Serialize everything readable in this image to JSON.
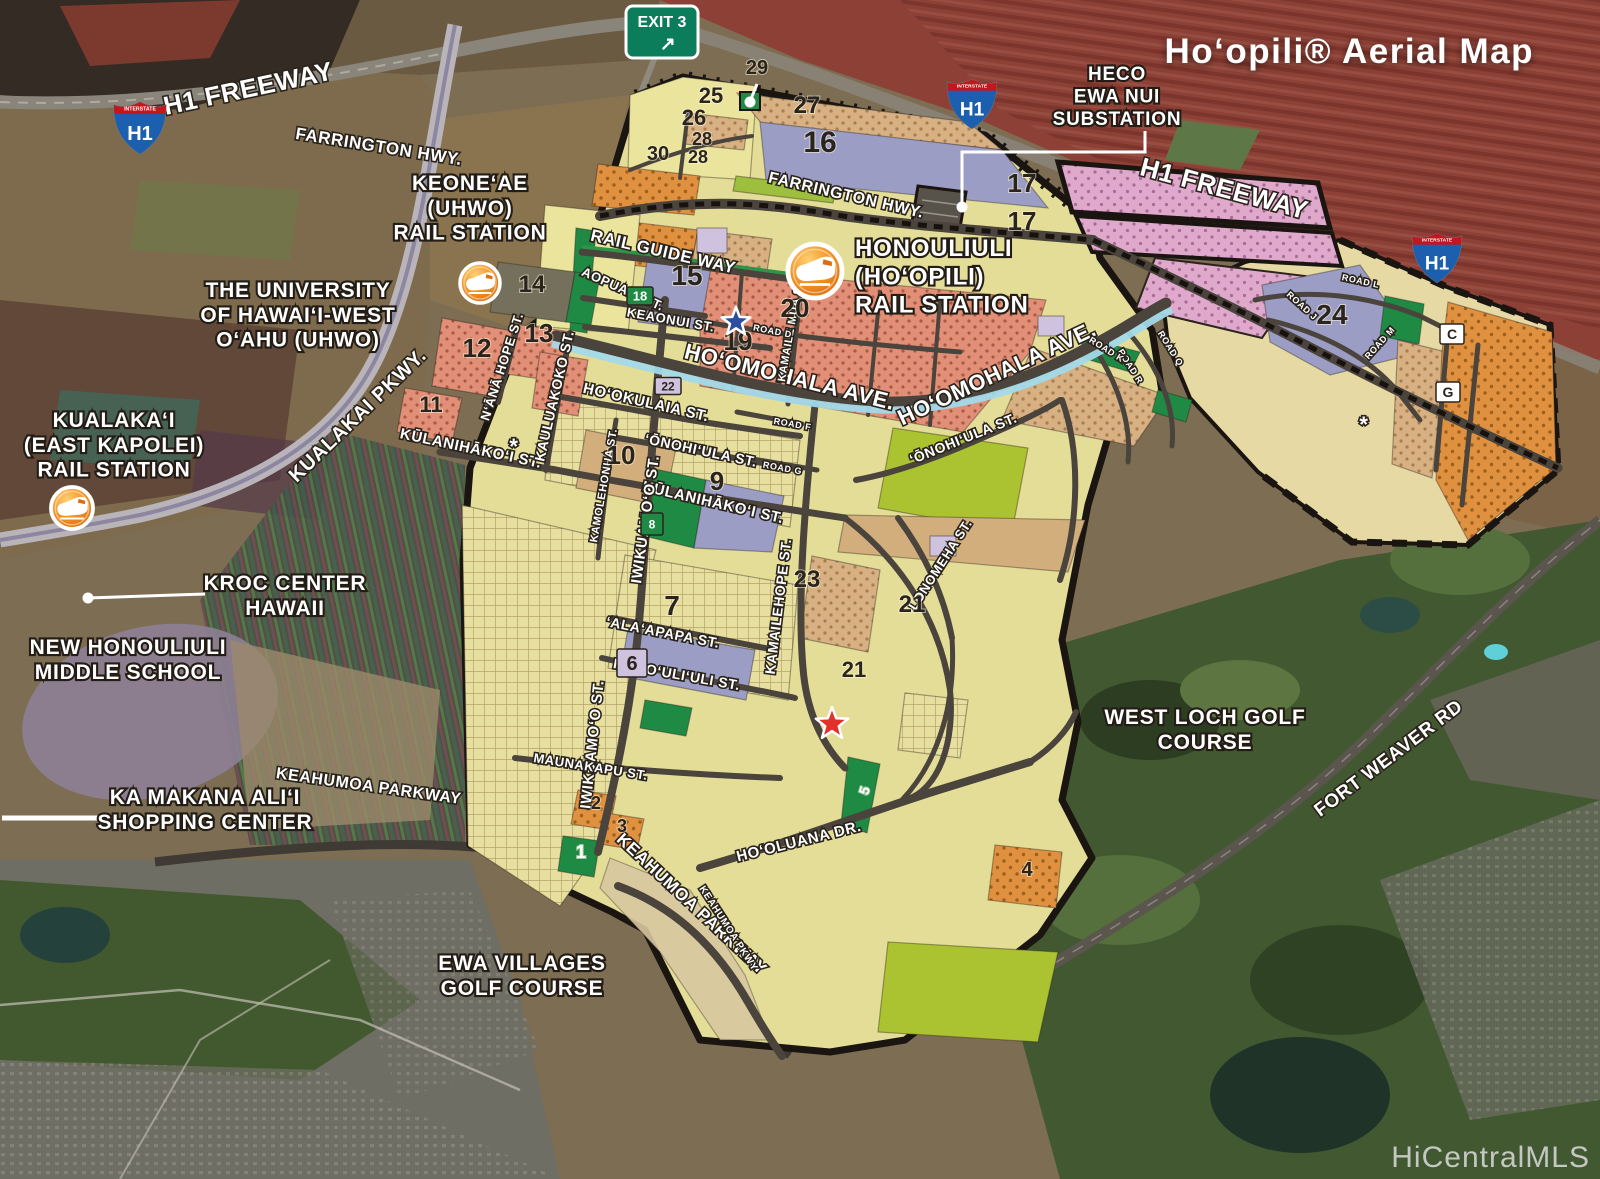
{
  "title": "Hoʻopili® Aerial Map",
  "watermark": "HiCentralMLS",
  "colors": {
    "parcel_salmon": "#e28f78",
    "parcel_tan": "#d7b183",
    "parcel_pink": "#dfa9cb",
    "parcel_khaki": "#e7df9f",
    "parcel_purple": "#9b9dc4",
    "parcel_lavender": "#cfc2df",
    "parcel_orange": "#e09140",
    "parcel_green": "#1e8a44",
    "parcel_lime": "#abc331",
    "road": "#4a443c",
    "water": "#a2d9e9",
    "boundary": "#1a1510",
    "station_orange": "#f08c1e",
    "exit_sign_green": "#0c7d5a",
    "shield_blue": "#1b5fae",
    "shield_red": "#c4161c"
  },
  "map": {
    "exit_sign": {
      "text": "EXIT 3",
      "arrow": "↗",
      "x": 626,
      "y": 6,
      "w": 72,
      "h": 52
    },
    "shields": [
      {
        "x": 140,
        "y": 127,
        "s": 1.0,
        "top": "INTERSTATE",
        "num": "H1"
      },
      {
        "x": 972,
        "y": 103,
        "s": 0.95,
        "top": "INTERSTATE",
        "num": "H1"
      },
      {
        "x": 1437,
        "y": 257,
        "s": 0.95,
        "top": "INTERSTATE",
        "num": "H1"
      }
    ],
    "stations": [
      {
        "id": "keoneae-station",
        "x": 480,
        "y": 283,
        "r": 20
      },
      {
        "id": "honouliuli-station",
        "x": 815,
        "y": 271,
        "r": 27
      },
      {
        "id": "kualakai-station",
        "x": 72,
        "y": 508,
        "r": 21
      }
    ],
    "stars": [
      {
        "color": "#2c4da0",
        "x": 736,
        "y": 322,
        "r": 15
      },
      {
        "color": "#e2302a",
        "x": 832,
        "y": 724,
        "r": 17
      }
    ],
    "asterisks": [
      {
        "x": 514,
        "y": 454
      },
      {
        "x": 1364,
        "y": 432
      }
    ],
    "leaders": [
      {
        "name": "heco-leader",
        "points": "1145,131 1145,152 962,152 962,204",
        "dot": [
          962,
          207
        ],
        "w": 3
      },
      {
        "name": "parcel29-leader",
        "points": "757,84 751,99",
        "dot": [
          750,
          102
        ],
        "w": 3
      },
      {
        "name": "kroc-leader",
        "points": "205,594 88,598",
        "dot": [
          88,
          598
        ],
        "w": 3
      },
      {
        "name": "kamakana-line",
        "points": "2,818 100,818",
        "w": 5
      }
    ],
    "place_labels": [
      {
        "id": "keoneae",
        "lines": [
          "KEONEʻAE",
          "(UHWO)",
          "RAIL STATION"
        ],
        "x": 470,
        "y": 190,
        "s": 21
      },
      {
        "id": "university",
        "lines": [
          "THE UNIVERSITY",
          "OF HAWAIʻI-WEST",
          "OʻAHU (UHWO)"
        ],
        "x": 298,
        "y": 297,
        "s": 21
      },
      {
        "id": "kualakai",
        "lines": [
          "KUALAKAʻI",
          "(EAST KAPOLEI)",
          "RAIL STATION"
        ],
        "x": 114,
        "y": 427,
        "s": 21
      },
      {
        "id": "heco",
        "lines": [
          "HECO",
          "EWA NUI",
          "SUBSTATION"
        ],
        "x": 1117,
        "y": 80,
        "s": 19
      },
      {
        "id": "honouliuli",
        "lines": [
          "HONOULIULI",
          "(HOʻOPILI)",
          "RAIL STATION"
        ],
        "x": 855,
        "y": 256,
        "s": 24,
        "align": "left"
      },
      {
        "id": "kroc",
        "lines": [
          "KROC CENTER",
          "HAWAII"
        ],
        "x": 285,
        "y": 590,
        "s": 21
      },
      {
        "id": "middle-school",
        "lines": [
          "NEW HONOULIULI",
          "MIDDLE SCHOOL"
        ],
        "x": 128,
        "y": 654,
        "s": 21
      },
      {
        "id": "ka-makana",
        "lines": [
          "KA MAKANA ALIʻI",
          "SHOPPING CENTER"
        ],
        "x": 205,
        "y": 804,
        "s": 21
      },
      {
        "id": "ewa-villages",
        "lines": [
          "EWA VILLAGES",
          "GOLF COURSE"
        ],
        "x": 522,
        "y": 970,
        "s": 21
      },
      {
        "id": "west-loch",
        "lines": [
          "WEST LOCH GOLF",
          "COURSE"
        ],
        "x": 1205,
        "y": 724,
        "s": 21
      }
    ],
    "street_labels": [
      {
        "t": "H1 FREEWAY",
        "x": 250,
        "y": 97,
        "r": -12,
        "s": 26
      },
      {
        "t": "FARRINGTON HWY.",
        "x": 378,
        "y": 152,
        "r": 9,
        "s": 17
      },
      {
        "t": "FARRINGTON HWY.",
        "x": 845,
        "y": 200,
        "r": 13,
        "s": 16
      },
      {
        "t": "H1 FREEWAY",
        "x": 1222,
        "y": 197,
        "r": 15,
        "s": 26
      },
      {
        "t": "RAIL GUIDE WAY",
        "x": 662,
        "y": 257,
        "r": 13,
        "s": 17
      },
      {
        "t": "AOPUAʻA ST.",
        "x": 621,
        "y": 293,
        "r": 24,
        "s": 13
      },
      {
        "t": "KEAONUI ST.",
        "x": 670,
        "y": 324,
        "r": 10,
        "s": 13
      },
      {
        "t": "HOʻOMOHALA AVE.",
        "x": 788,
        "y": 384,
        "r": 14,
        "s": 22
      },
      {
        "t": "HOʻOMOHALA AVE.",
        "x": 1000,
        "y": 380,
        "r": -25,
        "s": 22
      },
      {
        "t": "HOʻOKULAIA ST.",
        "x": 645,
        "y": 407,
        "r": 13,
        "s": 15
      },
      {
        "t": "ʻŌNOHIʻULA ST.",
        "x": 700,
        "y": 455,
        "r": 12,
        "s": 14
      },
      {
        "t": "ʻŌNOHIʻULA ST.",
        "x": 965,
        "y": 443,
        "r": -22,
        "s": 14
      },
      {
        "t": "KŪLANIHĀKOʻI ST.",
        "x": 470,
        "y": 453,
        "r": 12,
        "s": 15
      },
      {
        "t": "KŪLANIHĀKOʻI ST.",
        "x": 712,
        "y": 507,
        "r": 13,
        "s": 15
      },
      {
        "t": "NʻĀNĀ HOPE ST.",
        "x": 506,
        "y": 368,
        "r": -72,
        "s": 13
      },
      {
        "t": "KAULUAKOKO ST.",
        "x": 559,
        "y": 397,
        "r": -77,
        "s": 14
      },
      {
        "t": "KAMOLEHONUA ST.",
        "x": 607,
        "y": 486,
        "r": -80,
        "s": 11
      },
      {
        "t": "IWIKUAMOʻO ST.",
        "x": 650,
        "y": 520,
        "r": -82,
        "s": 15
      },
      {
        "t": "IWIKUAMOʻO ST.",
        "x": 597,
        "y": 745,
        "r": -84,
        "s": 15
      },
      {
        "t": "KAMAILE MUA ST.",
        "x": 794,
        "y": 330,
        "r": -80,
        "s": 11
      },
      {
        "t": "KAMAILEHOPE ST.",
        "x": 783,
        "y": 607,
        "r": -83,
        "s": 14
      },
      {
        "t": "LONOMEHA ST.",
        "x": 944,
        "y": 567,
        "r": -57,
        "s": 13
      },
      {
        "t": "ʻALAʻAPAPA ST.",
        "x": 662,
        "y": 637,
        "r": 11,
        "s": 14
      },
      {
        "t": "HONOʻULIʻULI ST.",
        "x": 676,
        "y": 679,
        "r": 10,
        "s": 14
      },
      {
        "t": "MAUNAKAPU ST.",
        "x": 590,
        "y": 771,
        "r": 9,
        "s": 13
      },
      {
        "t": "HOʻOLUANA DR.",
        "x": 800,
        "y": 846,
        "r": -14,
        "s": 15
      },
      {
        "t": "KEAHUMOA PARKWAY",
        "x": 688,
        "y": 908,
        "r": 43,
        "s": 17
      },
      {
        "t": "KEAHUMOA PKWY",
        "x": 726,
        "y": 930,
        "r": 57,
        "s": 10
      },
      {
        "t": "KEAHUMOA PARKWAY",
        "x": 368,
        "y": 791,
        "r": 8,
        "s": 16
      },
      {
        "t": "KUALAKAI PKWY.",
        "x": 362,
        "y": 420,
        "r": -44,
        "s": 20
      },
      {
        "t": "FORT WEAVER RD",
        "x": 1392,
        "y": 763,
        "r": -37,
        "s": 19
      },
      {
        "t": "ROAD D",
        "x": 772,
        "y": 334,
        "r": 11,
        "s": 9
      },
      {
        "t": "ROAD F",
        "x": 792,
        "y": 427,
        "r": 10,
        "s": 9
      },
      {
        "t": "ROAD G",
        "x": 782,
        "y": 471,
        "r": 10,
        "s": 9
      },
      {
        "t": "ROAD L",
        "x": 1360,
        "y": 284,
        "r": 12,
        "s": 9
      },
      {
        "t": "ROAD J",
        "x": 1300,
        "y": 308,
        "r": 42,
        "s": 9
      },
      {
        "t": "ROAD M",
        "x": 1382,
        "y": 345,
        "r": -48,
        "s": 9
      },
      {
        "t": "ROAD Q",
        "x": 1168,
        "y": 350,
        "r": 58,
        "s": 9
      },
      {
        "t": "ROAD R",
        "x": 1128,
        "y": 368,
        "r": 58,
        "s": 9
      },
      {
        "t": "ROAD K",
        "x": 1105,
        "y": 352,
        "r": 32,
        "s": 9
      }
    ],
    "parcel_numbers": [
      {
        "n": "29",
        "x": 757,
        "y": 74,
        "s": 20
      },
      {
        "n": "25",
        "x": 711,
        "y": 103,
        "s": 22
      },
      {
        "n": "26",
        "x": 694,
        "y": 125,
        "s": 22
      },
      {
        "n": "28",
        "x": 702,
        "y": 145,
        "s": 18
      },
      {
        "n": "30",
        "x": 658,
        "y": 160,
        "s": 20
      },
      {
        "n": "28",
        "x": 698,
        "y": 163,
        "s": 18
      },
      {
        "n": "27",
        "x": 807,
        "y": 113,
        "s": 24
      },
      {
        "n": "16",
        "x": 820,
        "y": 152,
        "s": 30
      },
      {
        "n": "17",
        "x": 1022,
        "y": 192,
        "s": 26
      },
      {
        "n": "17",
        "x": 1022,
        "y": 230,
        "s": 26
      },
      {
        "n": "15",
        "x": 687,
        "y": 285,
        "s": 28
      },
      {
        "n": "20",
        "x": 795,
        "y": 317,
        "s": 26
      },
      {
        "n": "19",
        "x": 738,
        "y": 350,
        "s": 26
      },
      {
        "n": "14",
        "x": 532,
        "y": 292,
        "s": 24
      },
      {
        "n": "13",
        "x": 539,
        "y": 342,
        "s": 26
      },
      {
        "n": "12",
        "x": 477,
        "y": 357,
        "s": 26
      },
      {
        "n": "11",
        "x": 431,
        "y": 412,
        "s": 22
      },
      {
        "n": "10",
        "x": 621,
        "y": 464,
        "s": 26
      },
      {
        "n": "9",
        "x": 717,
        "y": 490,
        "s": 26
      },
      {
        "n": "23",
        "x": 807,
        "y": 587,
        "s": 24
      },
      {
        "n": "21",
        "x": 912,
        "y": 612,
        "s": 24
      },
      {
        "n": "21",
        "x": 854,
        "y": 677,
        "s": 22
      },
      {
        "n": "7",
        "x": 672,
        "y": 615,
        "s": 28
      },
      {
        "n": "24",
        "x": 1332,
        "y": 324,
        "s": 28
      },
      {
        "n": "4",
        "x": 1027,
        "y": 876,
        "s": 20
      },
      {
        "n": "2",
        "x": 596,
        "y": 809,
        "s": 18
      },
      {
        "n": "3",
        "x": 622,
        "y": 832,
        "s": 18
      },
      {
        "n": "1",
        "x": 581,
        "y": 858,
        "s": 18,
        "fill": "#ffffff"
      },
      {
        "n": "5",
        "x": 869,
        "y": 792,
        "s": 14,
        "fill": "#ffffff",
        "r": -72
      }
    ],
    "badges": [
      {
        "t": "18",
        "x": 640,
        "y": 296,
        "w": 26,
        "h": 18,
        "bg": "#1e8a44",
        "fg": "#ffffff",
        "s": 13
      },
      {
        "t": "22",
        "x": 668,
        "y": 386,
        "w": 26,
        "h": 17,
        "bg": "#cfc2df",
        "fg": "#2a241d",
        "s": 12
      },
      {
        "t": "6",
        "x": 632,
        "y": 663,
        "w": 30,
        "h": 28,
        "bg": "#cfc2df",
        "fg": "#2a241d",
        "s": 20
      },
      {
        "t": "8",
        "x": 652,
        "y": 524,
        "w": 22,
        "h": 22,
        "bg": "#1e8a44",
        "fg": "#ffffff",
        "s": 12
      },
      {
        "t": "C",
        "x": 1452,
        "y": 334,
        "w": 24,
        "h": 20,
        "bg": "#ffffff",
        "fg": "#2a241d",
        "s": 14
      },
      {
        "t": "G",
        "x": 1448,
        "y": 392,
        "w": 24,
        "h": 20,
        "bg": "#ffffff",
        "fg": "#2a241d",
        "s": 14
      }
    ]
  }
}
